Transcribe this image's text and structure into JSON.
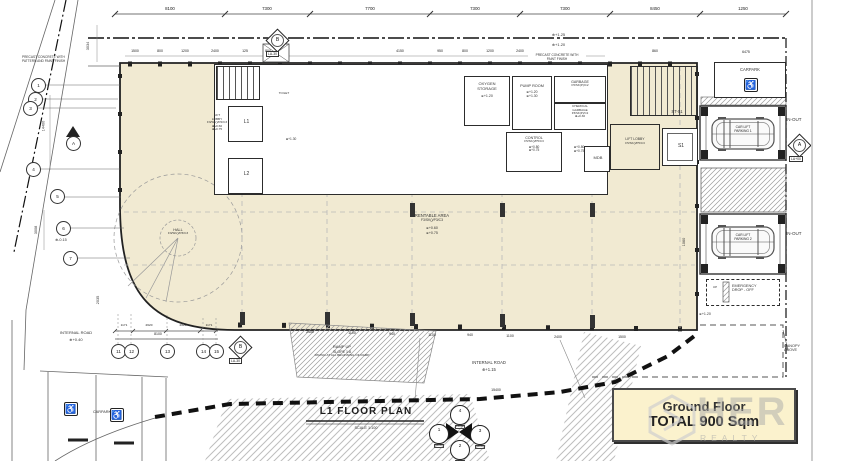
{
  "title_box": {
    "line1": "Ground Floor",
    "line2": "TOTAL 900 Sqm"
  },
  "plan_title": {
    "text": "L1 FLOOR PLAN",
    "scale": "SCALE 1:100"
  },
  "watermark": {
    "main": "HER",
    "sub": "REALTY"
  },
  "notes": {
    "left_a": "PRECAST CONCRETE WITH",
    "left_b": "PATTERN AND PAINT FINISH",
    "top_a": "PRECAST CONCRETE WITH",
    "top_b": "PAINT FINISH",
    "canopy_a": "CANOPY",
    "canopy_b": "ABOVE"
  },
  "levels": {
    "top1": "+1.25",
    "top2": "+1.20",
    "left": "-0.15",
    "road_left": "+0.40",
    "road_bottom": "+1.15",
    "emergency": "+1.20"
  },
  "rooms": {
    "lobby_left": {
      "n1": "LIFT",
      "n2": "LOBBY",
      "code": "F3/SK()/P2/C3",
      "lv1": "+0.60",
      "lv2": "+0.75"
    },
    "lift1": "L1",
    "lift2": "L2",
    "toilet": {
      "name": "TOILET",
      "lv": "+1.30"
    },
    "oxygen": {
      "n1": "OXYGEN",
      "n2": "STORAGE",
      "lv": "+1.20"
    },
    "pump": {
      "name": "PUMP ROOM",
      "lv1": "+1.20",
      "lv2": "+1.30"
    },
    "garbage": {
      "name": "GARBAGE",
      "code": "F5/SK(P)/C2"
    },
    "chemical": {
      "n1": "CHEMICAL",
      "n2": "GARBAGE",
      "code": "F5/SK(P)/C2",
      "lv": "+0.30"
    },
    "control": {
      "name": "CONTROL",
      "code": "F5/SK()/P5/C3",
      "lv1": "+0.80",
      "lv2": "+0.75",
      "lv3": "+0.80",
      "lv4": "+0.75"
    },
    "mdb": "MDB",
    "stair": "ST-01",
    "s1": "S1",
    "lobby_right": {
      "n1": "LIFT LOBBY",
      "code": "F5/SK()/P5/C3"
    },
    "hall": {
      "name": "HALL",
      "code": "F3/SK()/P3/C3"
    },
    "rentable": {
      "name": "RENTABLE AREA",
      "code": "F3/SK()/P3/C3",
      "lv1": "+0.60",
      "lv2": "+0.75"
    },
    "carpark_right": "CARPARK",
    "bay1": {
      "l1": "CAR LIFT",
      "l2": "PARKING 1",
      "inout": "IN-OUT"
    },
    "bay2": {
      "l1": "CAR LIFT",
      "l2": "PARKING 2",
      "inout": "IN-OUT"
    },
    "emergency": {
      "l1": "EMERGENCY",
      "l2": "DROP - OFF",
      "up": "UP"
    },
    "carpark_bottom": "CARPARK",
    "road_left": "INTERNAL ROAD",
    "road_bottom": "INTERNAL ROAD",
    "ramp": {
      "l1": "RAMP UP",
      "l2": "SLOPE 1:8",
      "l3": "PAVING AT ALL BEGINNING OF RAMP"
    }
  },
  "dims": {
    "top": [
      "8100",
      "7300",
      "7700",
      "7300",
      "7300",
      "8450",
      "1250"
    ],
    "small": [
      "1500",
      "800",
      "1200",
      "2400",
      "125",
      "800",
      "4150",
      "950",
      "800",
      "1200",
      "2400",
      "860"
    ],
    "left": [
      "3034",
      "14400",
      "3008",
      "2035"
    ],
    "right": [
      "6475",
      "1060"
    ],
    "bottom": [
      "2400",
      "1100",
      "940",
      "1100",
      "940",
      "1100",
      "2400",
      "1500"
    ],
    "sub": [
      "1171",
      "2620",
      "2620",
      "1171"
    ],
    "sub_total": "8100",
    "bottom_total": "15400"
  },
  "grid": {
    "left": [
      "1",
      "2",
      "3",
      "4",
      "5",
      "6",
      "7"
    ],
    "bottom": [
      "11",
      "12",
      "13",
      "14",
      "15"
    ],
    "b_label": "B",
    "b_tag": "LA-30",
    "a_label": "A",
    "a_tag": "LA+00",
    "section": "A",
    "kp_top": "4",
    "kp_left": "1",
    "kp_right": "3",
    "kp_bottom": "2",
    "kp_tag": "LA-00"
  }
}
